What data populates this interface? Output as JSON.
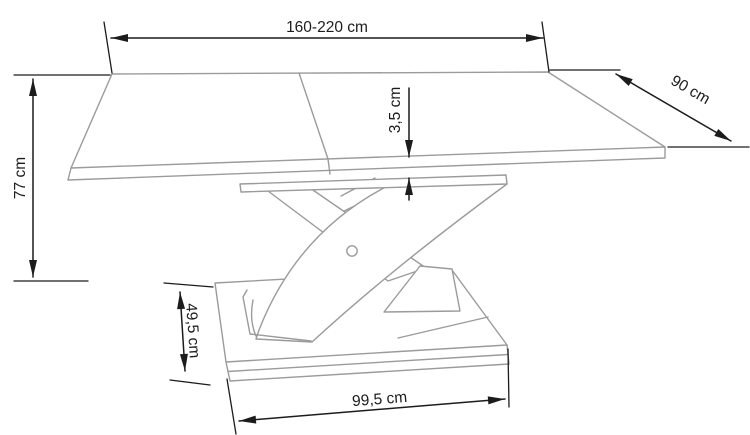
{
  "diagram": {
    "subject": "extendable-table-dimension-drawing",
    "dimensions": {
      "tabletop_length": {
        "label": "160-220 cm"
      },
      "tabletop_depth": {
        "label": "90 cm"
      },
      "table_height": {
        "label": "77 cm"
      },
      "tabletop_thickness": {
        "label": "3,5 cm"
      },
      "base_depth": {
        "label": "49,5 cm"
      },
      "base_width": {
        "label": "99,5 cm"
      }
    }
  },
  "colors": {
    "outline": "#9b9b9b",
    "dimension": "#1c1c1c",
    "background": "#ffffff"
  }
}
